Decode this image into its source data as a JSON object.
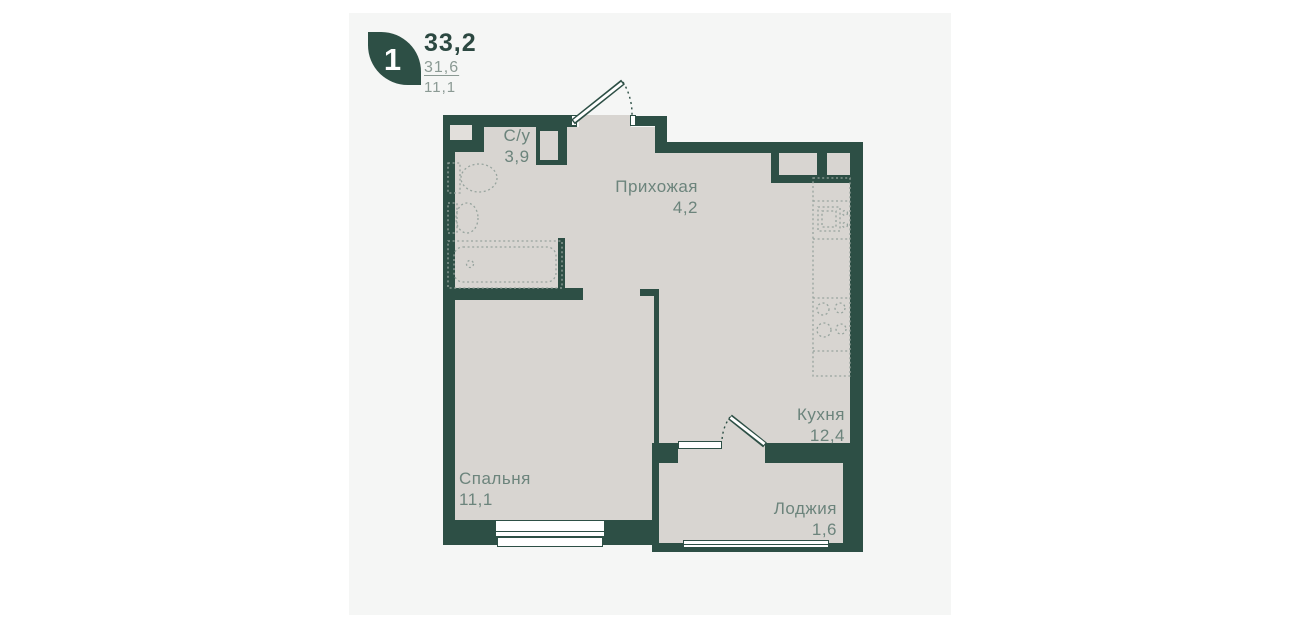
{
  "header": {
    "rooms_count": "1",
    "area_total": "33,2",
    "area_living": "31,6",
    "area_kitchen": "11,1"
  },
  "rooms": {
    "bathroom": {
      "label": "С/у",
      "area": "3,9"
    },
    "hallway": {
      "label": "Прихожая",
      "area": "4,2"
    },
    "kitchen": {
      "label": "Кухня",
      "area": "12,4"
    },
    "bedroom": {
      "label": "Спальня",
      "area": "11,1"
    },
    "loggia": {
      "label": "Лоджия",
      "area": "1,6"
    }
  },
  "colors": {
    "wall": "#2d4f45",
    "floor": "#d8d5d1",
    "card": "#f5f6f5",
    "page": "#ffffff",
    "label": "#6c847c",
    "accent": "#2c4841",
    "muted": "#8b9a94",
    "fixture": "#97a49e"
  }
}
